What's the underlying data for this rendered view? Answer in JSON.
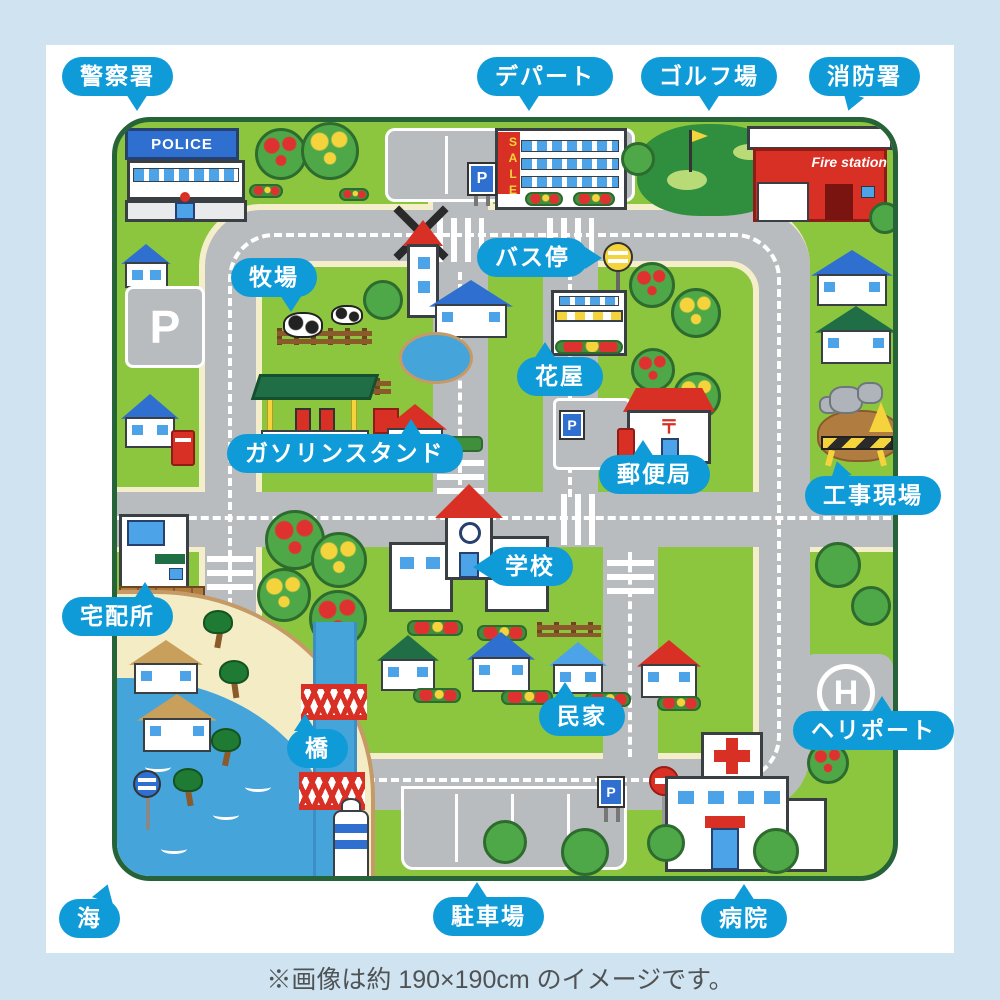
{
  "caption": "※画像は約 190×190cm のイメージです。",
  "colors": {
    "label_blue": "#0f9bd8",
    "frame_blue": "#cfe3f0",
    "mat_green": "#8cc63e",
    "mat_edge_green": "#276339",
    "road_gray": "#b9bcbe",
    "road_edge_cream": "#f5eecb",
    "sea_blue": "#45a4da",
    "sand": "#f3ecc5"
  },
  "labels": [
    {
      "id": "police-station",
      "text": "警察署"
    },
    {
      "id": "department-store",
      "text": "デパート"
    },
    {
      "id": "golf-course",
      "text": "ゴルフ場"
    },
    {
      "id": "fire-station",
      "text": "消防署"
    },
    {
      "id": "bus-stop",
      "text": "バス停"
    },
    {
      "id": "ranch",
      "text": "牧場"
    },
    {
      "id": "flower-shop",
      "text": "花屋"
    },
    {
      "id": "gas-station",
      "text": "ガソリンスタンド"
    },
    {
      "id": "post-office",
      "text": "郵便局"
    },
    {
      "id": "construction-site",
      "text": "工事現場"
    },
    {
      "id": "school",
      "text": "学校"
    },
    {
      "id": "delivery-center",
      "text": "宅配所"
    },
    {
      "id": "private-houses",
      "text": "民家"
    },
    {
      "id": "heliport",
      "text": "ヘリポート"
    },
    {
      "id": "bridge",
      "text": "橋"
    },
    {
      "id": "sea",
      "text": "海"
    },
    {
      "id": "parking-lot",
      "text": "駐車場"
    },
    {
      "id": "hospital",
      "text": "病院"
    }
  ],
  "mat_signs": {
    "police_sign": "POLICE",
    "sale_banner": "SALE",
    "fire_station_sign": "Fire station",
    "parking_p": "P",
    "heliport_h": "H",
    "post_mark": "〒"
  }
}
